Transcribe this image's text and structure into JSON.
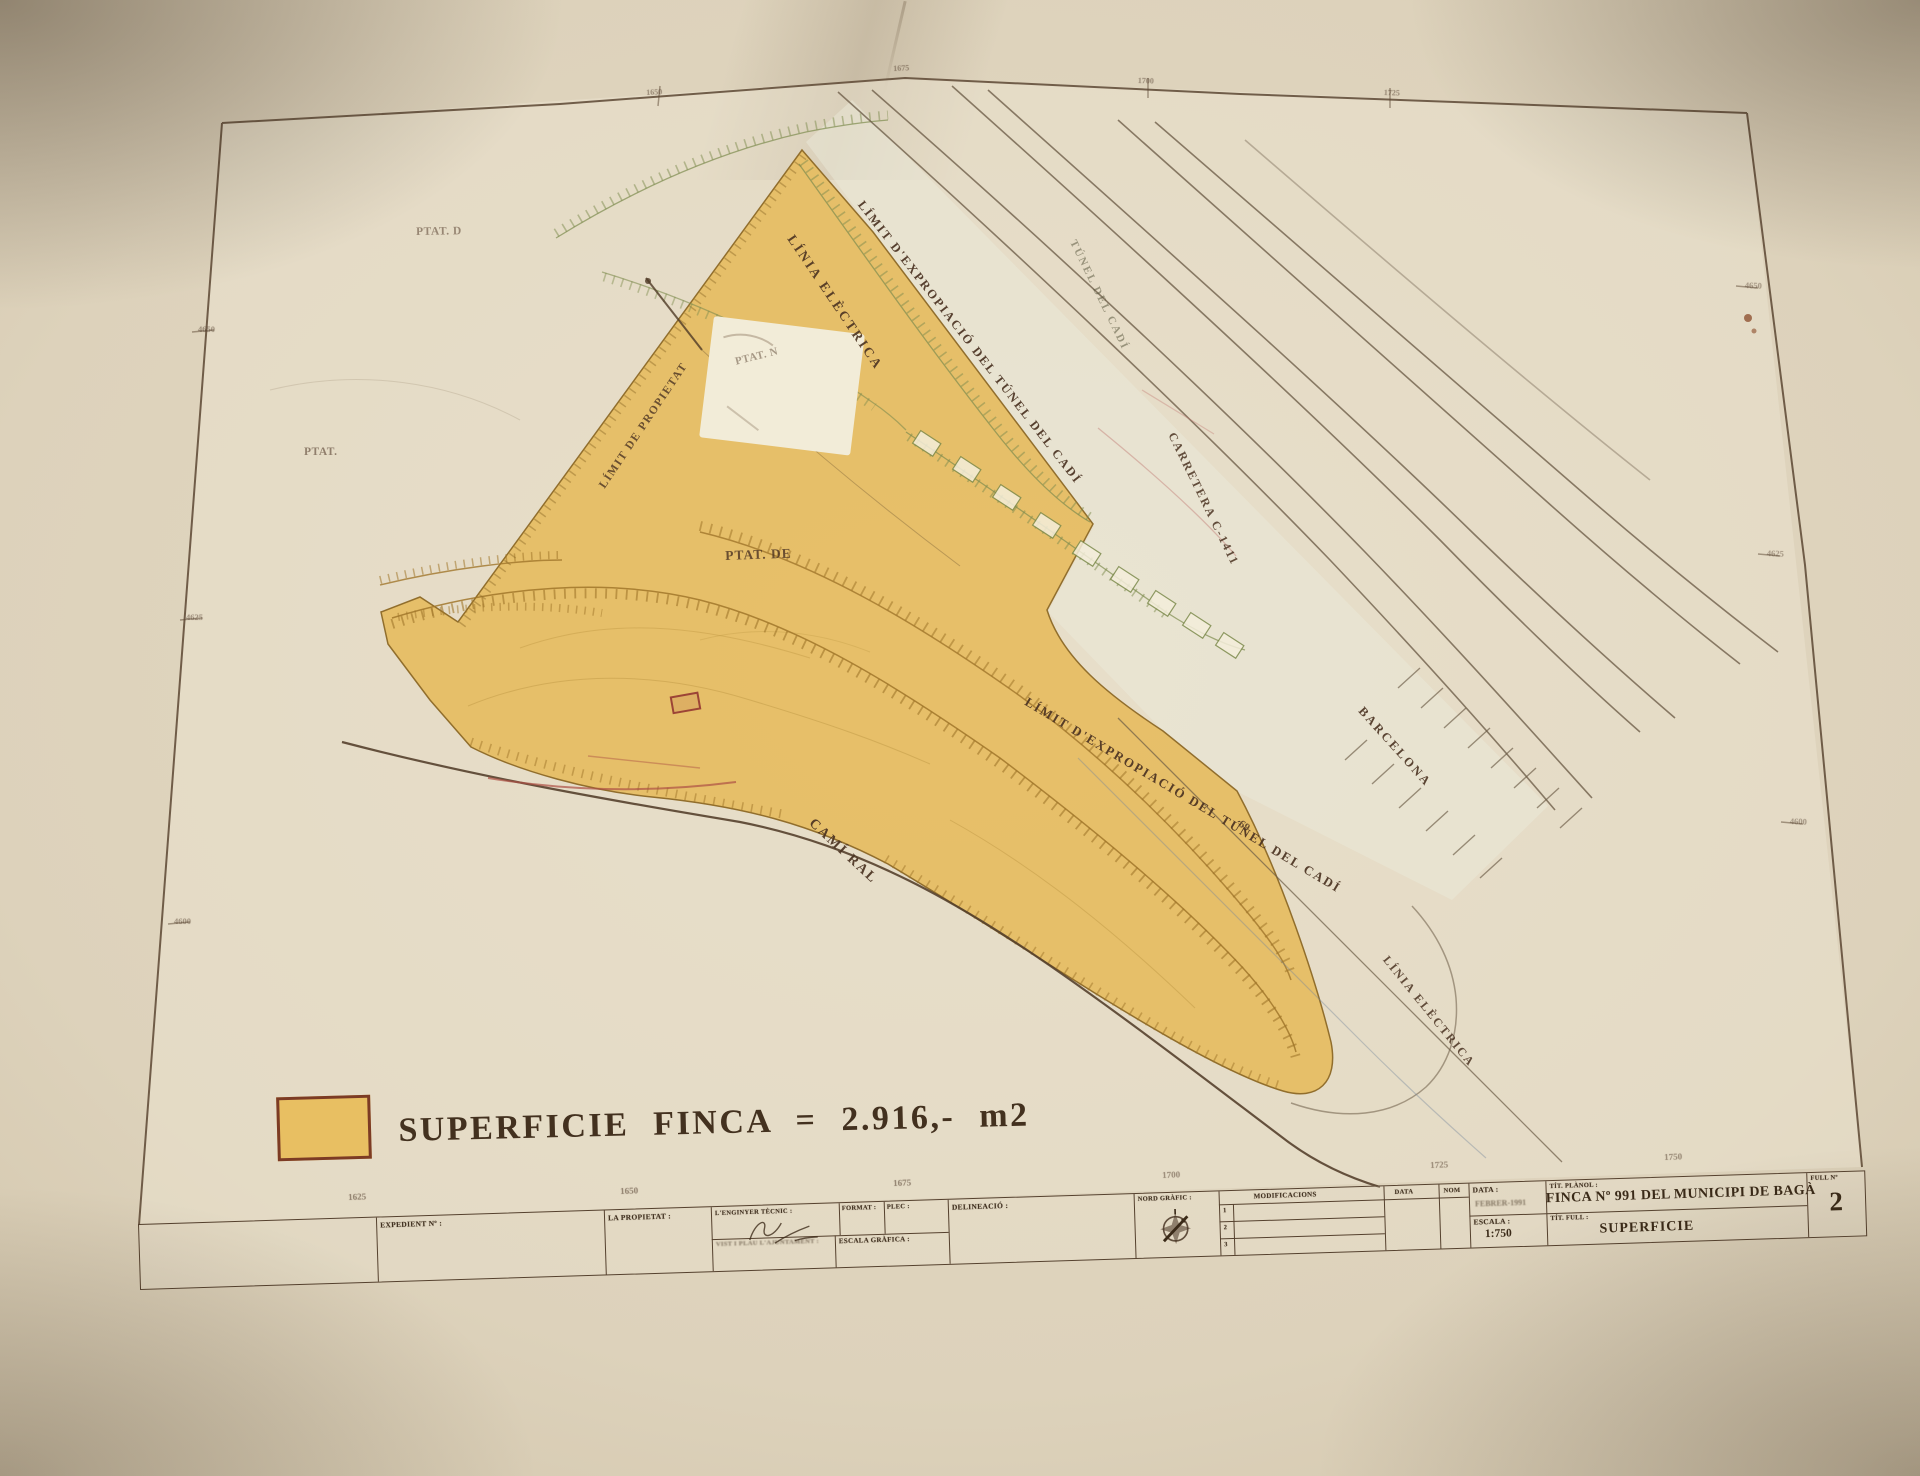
{
  "document": {
    "legend": {
      "swatch_color": "#e8bf62",
      "swatch_border": "#7c3b24",
      "text": "SUPERFICIE FINCA = 2.916,- m2"
    },
    "labels": [
      {
        "id": "linia-electrica-top",
        "text": "LÍNIA ELÈCTRICA",
        "x": 797,
        "y": 232,
        "rot": 56,
        "size": 13.5,
        "ls": 2.5,
        "op": 0.9
      },
      {
        "id": "limit-expropiacio-top",
        "text": "LÍMIT D'EXPROPIACIÓ DEL TÚNEL DEL CADÍ",
        "x": 866,
        "y": 198,
        "rot": 52,
        "size": 12.5,
        "ls": 2,
        "op": 0.92
      },
      {
        "id": "tunel-del-cadi",
        "text": "TÚNEL DEL CADÍ",
        "x": 1078,
        "y": 238,
        "rot": 64,
        "size": 11,
        "ls": 2,
        "op": 0.55,
        "color": "#5c5940"
      },
      {
        "id": "carretera-c-1411",
        "text": "CARRETERA C-1411",
        "x": 1178,
        "y": 430,
        "rot": 64,
        "size": 12,
        "ls": 2,
        "op": 0.85
      },
      {
        "id": "barcelona",
        "text": "BARCELONA",
        "x": 1366,
        "y": 704,
        "rot": 48,
        "size": 12.5,
        "ls": 2.5,
        "op": 0.9
      },
      {
        "id": "limit-expropiacio-mid",
        "text": "LÍMIT D'EXPROPIACIÓ DEL TÚNEL DEL CADÍ",
        "x": 1030,
        "y": 694,
        "rot": 31,
        "size": 13,
        "ls": 2,
        "op": 0.92
      },
      {
        "id": "num-69",
        "text": "69",
        "x": 1243,
        "y": 818,
        "rot": 35,
        "size": 11,
        "ls": 0,
        "op": 0.8
      },
      {
        "id": "cami-ral",
        "text": "CAMÍ RAL",
        "x": 816,
        "y": 816,
        "rot": 43,
        "size": 14,
        "ls": 2,
        "op": 0.92
      },
      {
        "id": "limit-de-propietat",
        "text": "LÍMIT DE PROPIETAT",
        "x": 597,
        "y": 484,
        "rot": -56,
        "size": 11.5,
        "ls": 1.5,
        "op": 0.8
      },
      {
        "id": "ptat-de",
        "text": "PTAT. DE",
        "x": 725,
        "y": 548,
        "rot": -2,
        "size": 13.5,
        "ls": 1,
        "op": 0.8
      },
      {
        "id": "ptat-left",
        "text": "PTAT.",
        "x": 304,
        "y": 446,
        "rot": 0,
        "size": 11.5,
        "ls": 0.5,
        "op": 0.55
      },
      {
        "id": "ptat-topleft",
        "text": "PTAT. D",
        "x": 416,
        "y": 226,
        "rot": -1,
        "size": 11.5,
        "ls": 0.5,
        "op": 0.5
      },
      {
        "id": "ptat-whitepatch",
        "text": "PTAT. N",
        "x": 734,
        "y": 356,
        "rot": -14,
        "size": 11,
        "ls": 0.5,
        "op": 0.45
      },
      {
        "id": "linia-electrica-bottom",
        "text": "LÍNIA ELÈCTRICA",
        "x": 1391,
        "y": 953,
        "rot": 51,
        "size": 12,
        "ls": 2,
        "op": 0.85
      }
    ],
    "ticks": [
      {
        "id": "b-1625",
        "text": "1625",
        "x": 348,
        "y": 1192,
        "rot": -2,
        "size": 9,
        "op": 0.5
      },
      {
        "id": "b-1650",
        "text": "1650",
        "x": 620,
        "y": 1186,
        "rot": -2,
        "size": 9,
        "op": 0.5
      },
      {
        "id": "b-1675",
        "text": "1675",
        "x": 893,
        "y": 1178,
        "rot": -2,
        "size": 9,
        "op": 0.5
      },
      {
        "id": "b-1700",
        "text": "1700",
        "x": 1162,
        "y": 1170,
        "rot": -2,
        "size": 9,
        "op": 0.45
      },
      {
        "id": "b-1725",
        "text": "1725",
        "x": 1430,
        "y": 1160,
        "rot": -2,
        "size": 9,
        "op": 0.45
      },
      {
        "id": "b-1750",
        "text": "1750",
        "x": 1664,
        "y": 1152,
        "rot": -2,
        "size": 9,
        "op": 0.45
      },
      {
        "id": "l-4650",
        "text": "4650",
        "x": 198,
        "y": 324,
        "rot": 0,
        "size": 8.5,
        "op": 0.42
      },
      {
        "id": "l-4625",
        "text": "4625",
        "x": 186,
        "y": 612,
        "rot": 0,
        "size": 8.5,
        "op": 0.42
      },
      {
        "id": "l-4600",
        "text": "4600",
        "x": 174,
        "y": 916,
        "rot": 0,
        "size": 8.5,
        "op": 0.42
      },
      {
        "id": "r-4650",
        "text": "4650",
        "x": 1745,
        "y": 280,
        "rot": 2,
        "size": 8.5,
        "op": 0.38
      },
      {
        "id": "r-4625",
        "text": "4625",
        "x": 1767,
        "y": 548,
        "rot": 2,
        "size": 8.5,
        "op": 0.38
      },
      {
        "id": "r-4600",
        "text": "4600",
        "x": 1790,
        "y": 816,
        "rot": 2,
        "size": 8.5,
        "op": 0.38
      },
      {
        "id": "t-1650",
        "text": "1650",
        "x": 646,
        "y": 88,
        "rot": -3,
        "size": 8,
        "op": 0.42
      },
      {
        "id": "t-1675",
        "text": "1675",
        "x": 893,
        "y": 64,
        "rot": -3,
        "size": 8,
        "op": 0.42
      },
      {
        "id": "t-1700",
        "text": "1700",
        "x": 1138,
        "y": 76,
        "rot": 2,
        "size": 8,
        "op": 0.42
      },
      {
        "id": "t-1725",
        "text": "1725",
        "x": 1384,
        "y": 88,
        "rot": 2,
        "size": 8,
        "op": 0.42
      }
    ],
    "title_block": {
      "expedient_label": "EXPEDIENT Nº :",
      "propietat_label": "LA PROPIETAT :",
      "enginyer_label": "L'ENGINYER TÈCNIC :",
      "format_label": "FORMAT :",
      "plec_label": "PLEC :",
      "vist_label": "VIST I PLAU L'AJUNTAMENT :",
      "escala_grafica_label": "ESCALA GRÀFICA :",
      "delineacio_label": "DELINEACIÓ :",
      "nord_label": "NORD GRÀFIC :",
      "mods_header": "MODIFICACIONS",
      "col_data": "DATA",
      "col_nom": "NOM",
      "row1": "1",
      "row2": "2",
      "row3": "3",
      "data_label": "DATA :",
      "data_value": "FEBRER-1991",
      "escala_label": "ESCALA :",
      "escala_value": "1:750",
      "tit_planol_label": "TÍT. PLÀNOL :",
      "planol_title": "FINCA Nº 991 DEL MUNICIPI DE BAGÀ",
      "tit_full_label": "TÍT. FULL :",
      "full_title": "SUPERFICIE",
      "full_num_label": "FULL Nº",
      "full_num": "2"
    }
  }
}
